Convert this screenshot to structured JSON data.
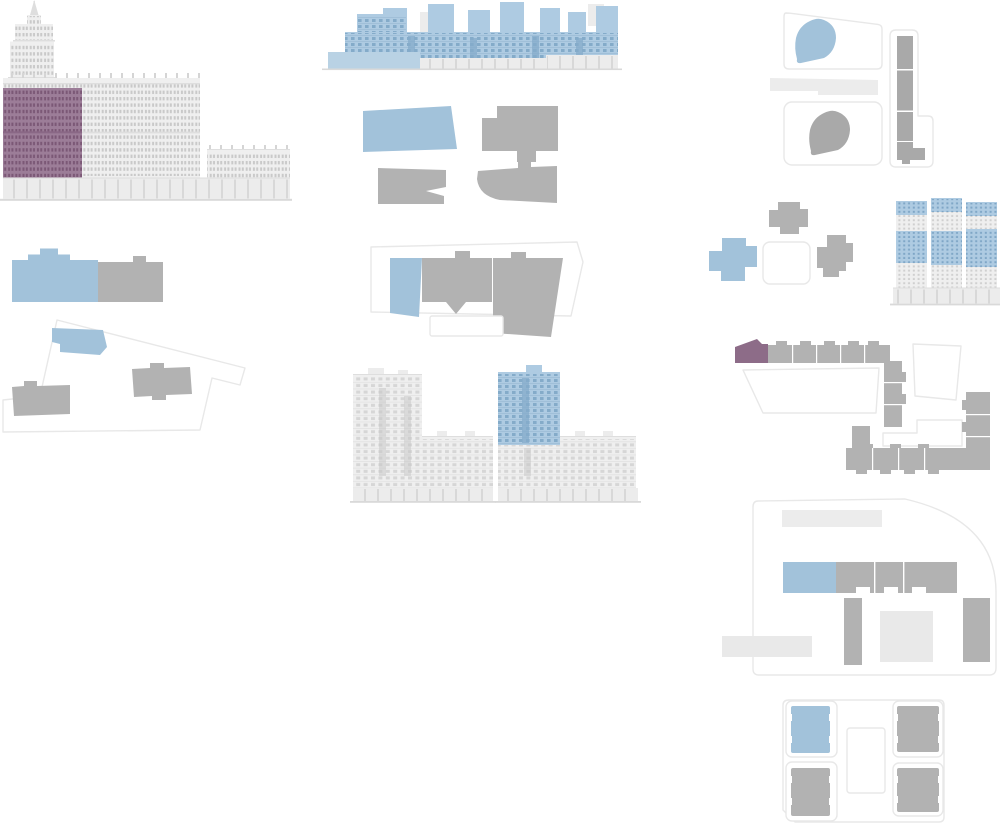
{
  "canvas": {
    "width": 1000,
    "height": 826
  },
  "palette": {
    "background": "#ffffff",
    "selected_blue": "#a2c2da",
    "blue_pale": "#b9d2e4",
    "elevation_blue": "#aecbe2",
    "blue_window": "#84abc9",
    "building_gray": "#b2b2b2",
    "blob_gray": "#a9a9a9",
    "light_gray": "#ececec",
    "lighter_gray": "#e9e9e9",
    "outline_stroke": "#e8e8e8",
    "selected_purple": "#8d6c88",
    "elevation_purple": "#9c7d98",
    "purple_window": "#7b5876",
    "purple_line": "#8a6886",
    "facade_white": "#efefef",
    "facade_window": "#c9c9c9",
    "facade_line": "#dedede",
    "ground_line": "#d9d9d9"
  },
  "groups": [
    {
      "id": "building-elevation-tower-block",
      "kind": "facade-elevation",
      "highlight": "purple"
    },
    {
      "id": "building-elevation-waterfront-slab",
      "kind": "facade-elevation",
      "highlight": "blue"
    },
    {
      "id": "floor-plan-footprints-cluster",
      "kind": "floor-plan",
      "highlight": "blue"
    },
    {
      "id": "site-plan-terraced",
      "kind": "site-plan",
      "highlight": "blue"
    },
    {
      "id": "site-plan-left-bar",
      "kind": "site-plan",
      "highlight": "blue"
    },
    {
      "id": "site-plan-left-chevron",
      "kind": "site-plan",
      "highlight": "blue"
    },
    {
      "id": "building-elevation-twin-towers",
      "kind": "facade-elevation",
      "highlight": "blue"
    },
    {
      "id": "site-plan-top-right",
      "kind": "site-plan",
      "highlight": "blue"
    },
    {
      "id": "site-plan-crosses",
      "kind": "site-plan",
      "highlight": "blue"
    },
    {
      "id": "building-elevation-three-towers",
      "kind": "facade-elevation",
      "highlight": "blue"
    },
    {
      "id": "site-plan-u-block",
      "kind": "site-plan",
      "highlight": "purple"
    },
    {
      "id": "site-plan-quarter-round",
      "kind": "site-plan",
      "highlight": "blue"
    },
    {
      "id": "site-plan-quad-courtyard",
      "kind": "site-plan",
      "highlight": "blue"
    }
  ]
}
